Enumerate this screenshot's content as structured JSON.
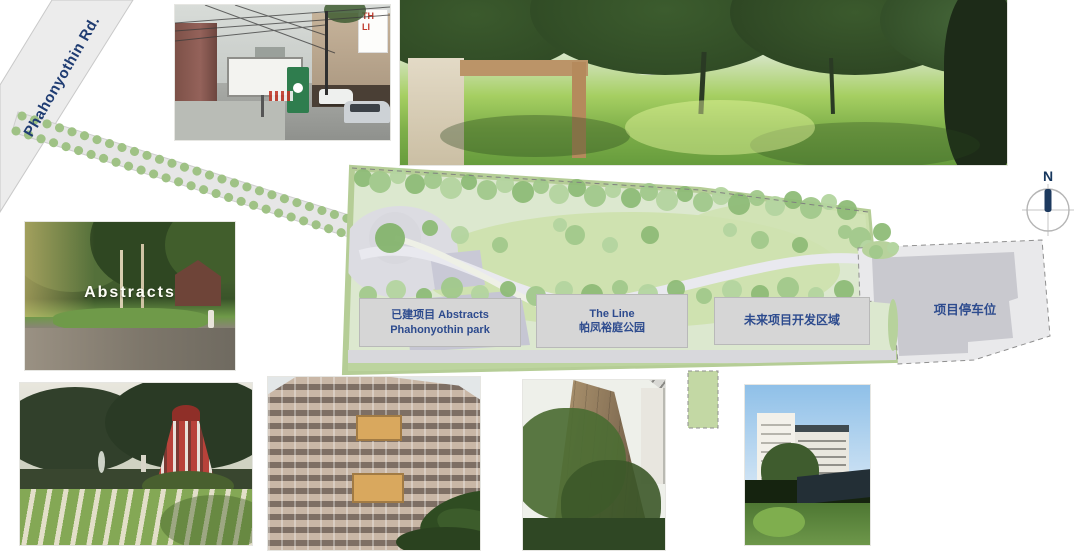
{
  "road": {
    "label": "Phahonyothin Rd."
  },
  "plan": {
    "labels": {
      "built": {
        "line1": "已建项目 Abstracts",
        "line2": "Phahonyothin park"
      },
      "theline": {
        "line1": "The Line",
        "line2": "帕凤裕庭公园"
      },
      "future": {
        "line1": "未来项目开发区域"
      },
      "parking": {
        "line1": "项目停车位"
      }
    }
  },
  "compass": {
    "north": "N"
  },
  "photos": {
    "street": {
      "signboard_line1": "TH",
      "signboard_line2": "LI"
    },
    "abstracts": {
      "sign_text": "Abstracts"
    }
  },
  "colors": {
    "label_text": "#2d4b8e",
    "label_box_bg": "#d6d6d6",
    "road_gray": "#ececec",
    "plan_lawn": "#cfe2b0",
    "plan_tree_green": "#8fbc78",
    "plan_border_green": "#b5cd96",
    "parking_gray": "#c9c9cf",
    "north_blue": "#17375e"
  }
}
